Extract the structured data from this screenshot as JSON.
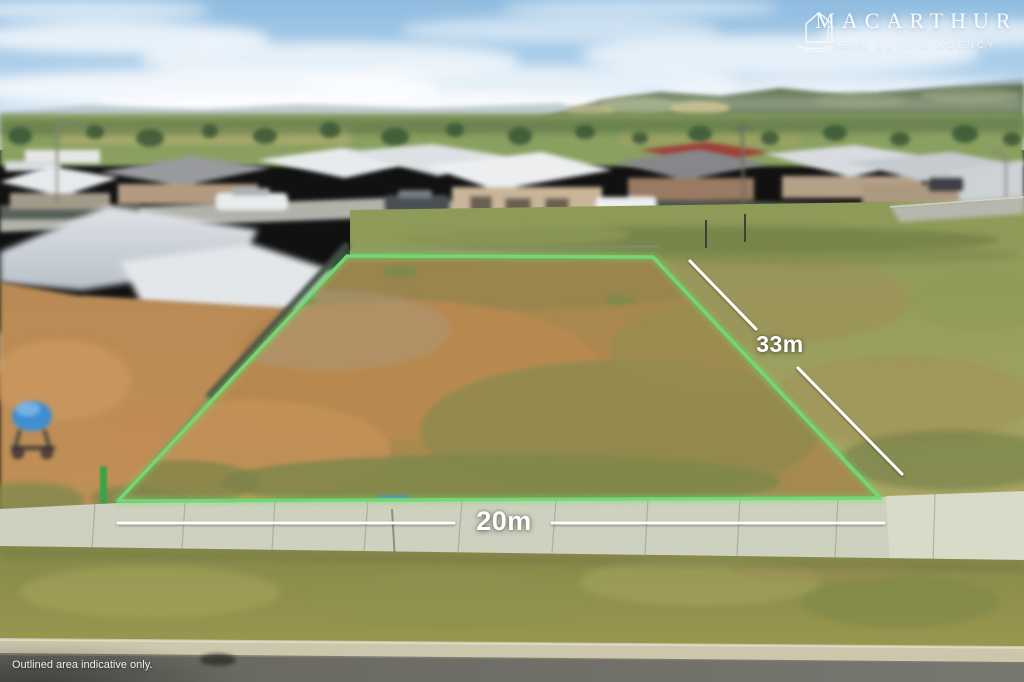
{
  "branding": {
    "name": "MACARTHUR",
    "tagline": "REAL ESTATE AGENCY"
  },
  "measurements": {
    "frontage": {
      "label": "20m"
    },
    "depth": {
      "label": "33m"
    }
  },
  "disclaimer": "Outlined area indicative only.",
  "colors": {
    "outline_green": "#72da74",
    "outline_glow": "#6fdc70",
    "measure_white": "#ffffff",
    "logo_white": "#f7fafc",
    "sky_top": "#8fbce0",
    "sky_horizon": "#dcebf5",
    "dirt_orange": "#b5884f",
    "grass_olive": "#939a55",
    "footpath_grey": "#ced1bf",
    "road_grey": "#6f6f6a"
  }
}
